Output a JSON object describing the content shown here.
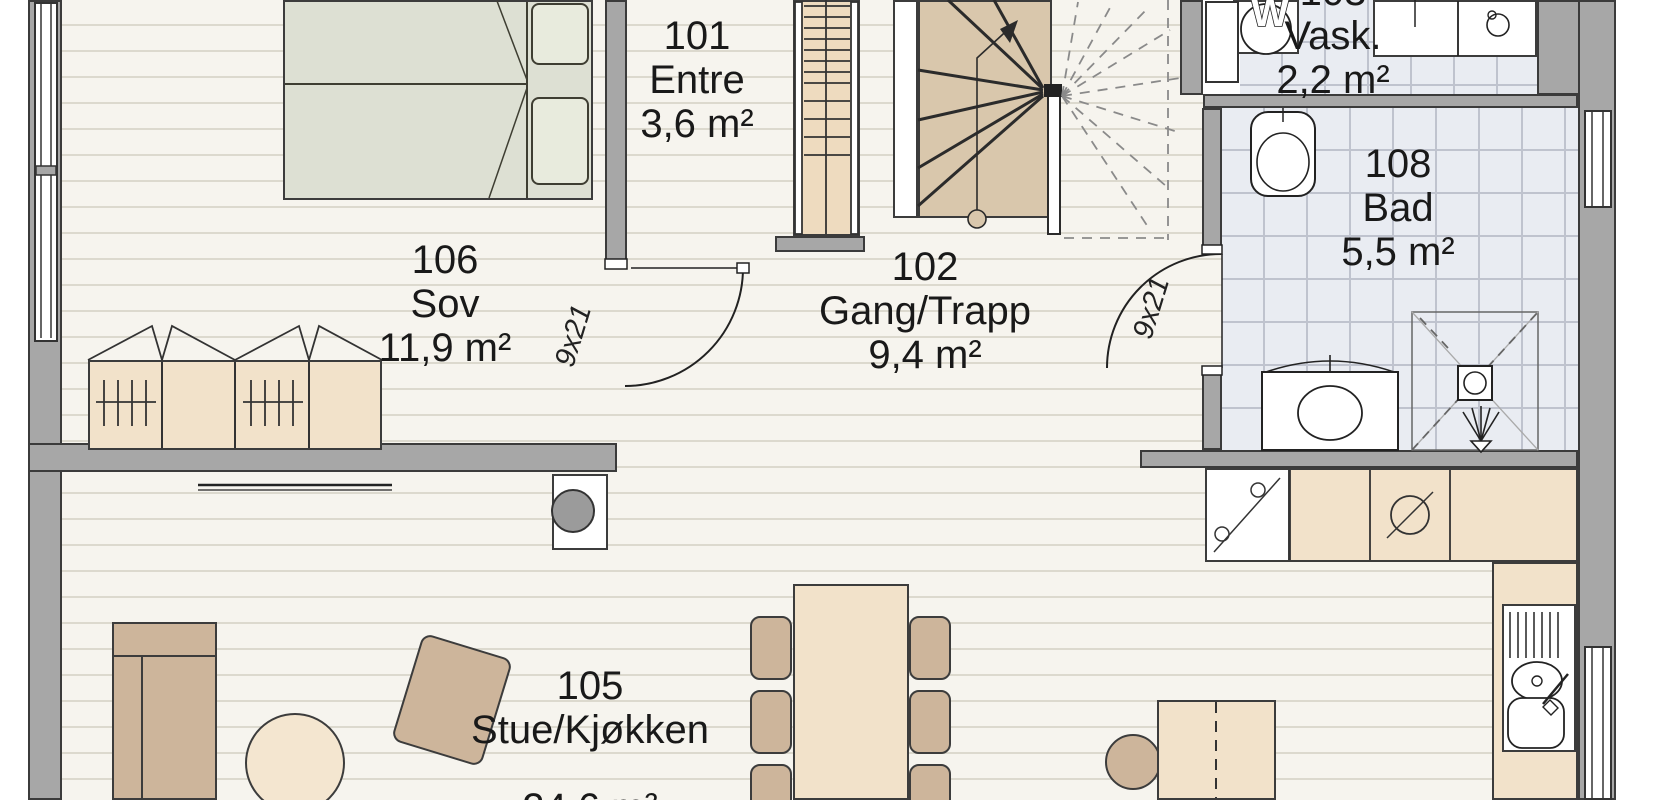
{
  "document": {
    "type": "architectural floor plan",
    "language": "Norwegian"
  },
  "rooms": {
    "r101": {
      "number": "101",
      "name": "Entre",
      "area": "3,6 m²"
    },
    "r102": {
      "number": "102",
      "name": "Gang/Trapp",
      "area": "9,4 m²"
    },
    "r103": {
      "number": "103",
      "name": "Vask.",
      "area": "2,2 m²"
    },
    "r105": {
      "number": "105",
      "name": "Stue/Kjøkken",
      "area": "24,6 m²"
    },
    "r106": {
      "number": "106",
      "name": "Sov",
      "area": "11,9 m²"
    },
    "r108": {
      "number": "108",
      "name": "Bad",
      "area": "5,5 m²"
    }
  },
  "doors": {
    "bedroom_door_label": "9x21",
    "bathroom_door_label": "9x21"
  },
  "appliances": {
    "washing_machine_label": "W"
  },
  "colors": {
    "floor": "#f6f4ee",
    "floor_stripe": "#dcd9ce",
    "tile_floor": "#e9ecf2",
    "tile_line": "#bfc3ce",
    "wall_fill": "#a7a7a7",
    "wall_outline": "#3b3b3b",
    "wood_furniture": "#f2e2ca",
    "upholstery": "#cdb59b",
    "bed": "#dde0d3",
    "stair": "#d9c7ac",
    "line": "#2f2f2f"
  }
}
